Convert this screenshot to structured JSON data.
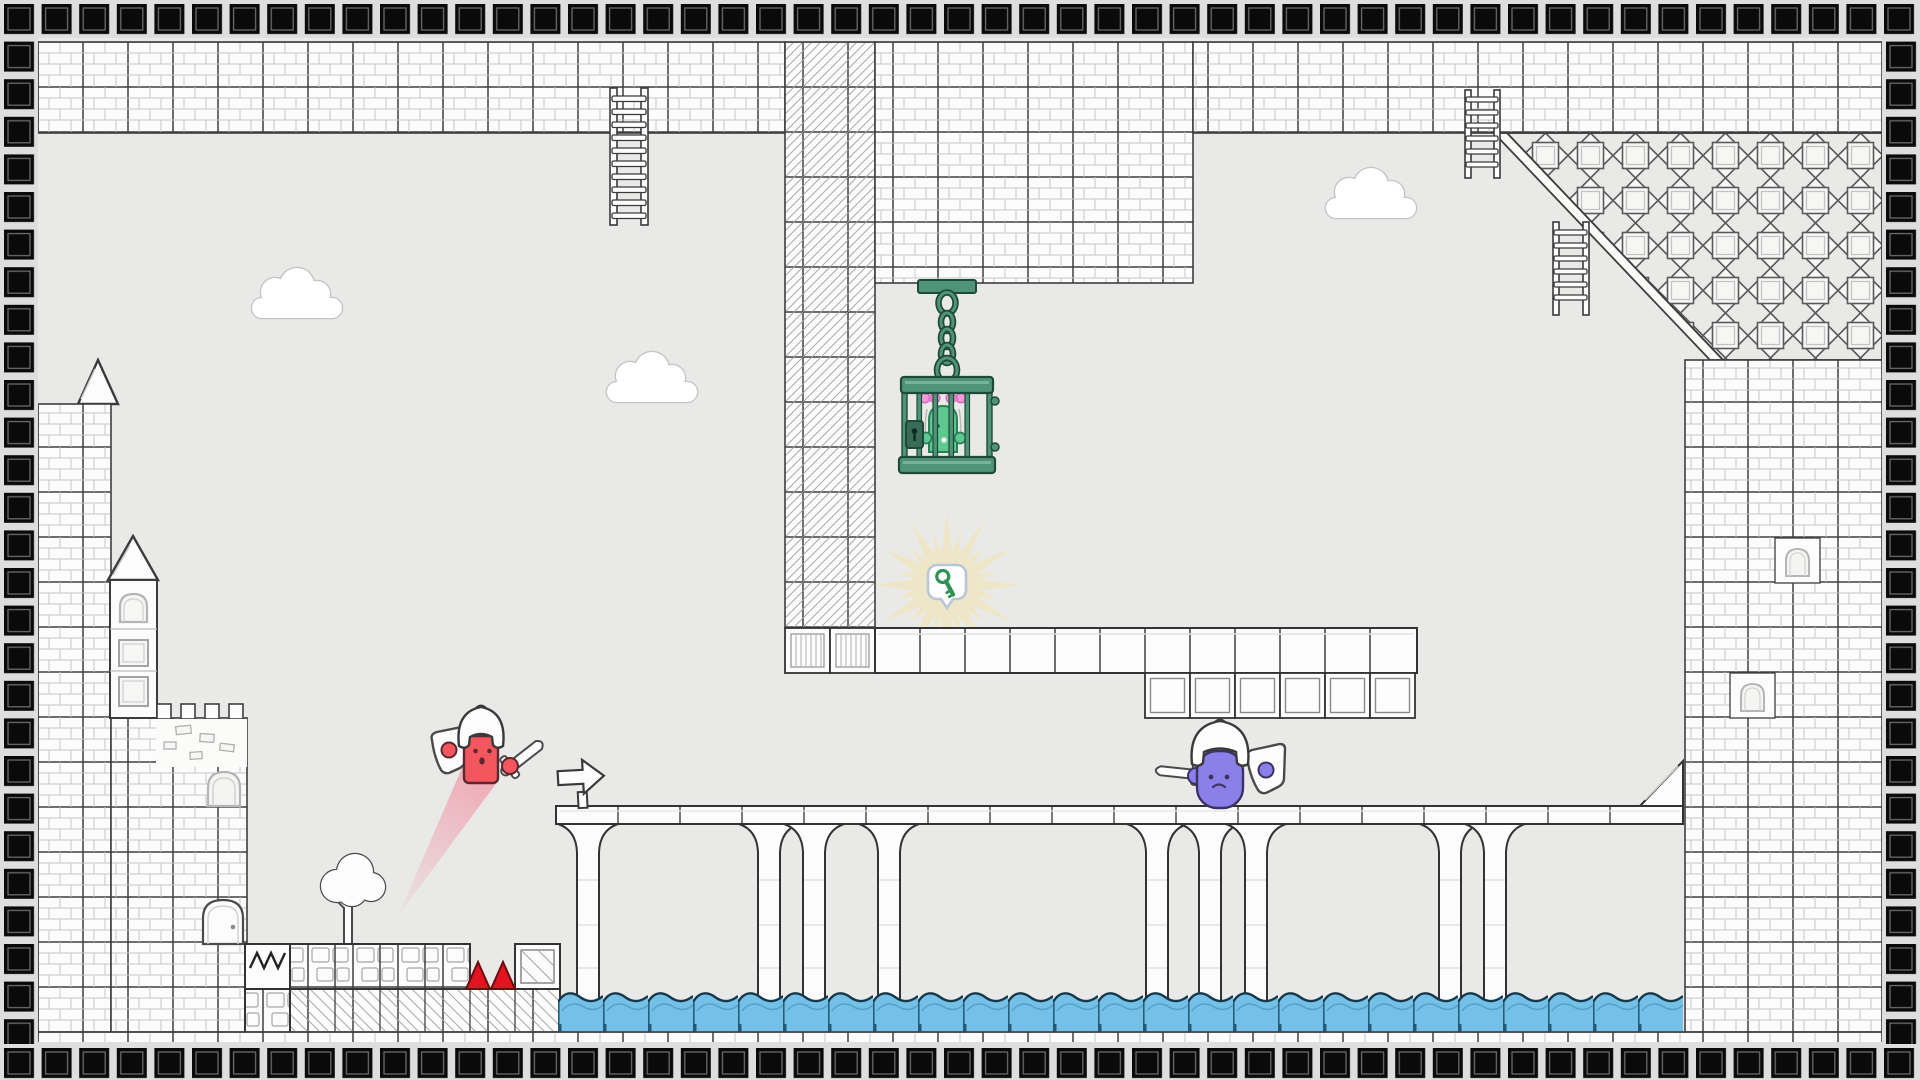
{
  "scene": {
    "name": "hand-drawn castle platformer level",
    "type": "game-screenshot"
  },
  "colors": {
    "page_bg": "#dedede",
    "area_bg": "#e9e9e7",
    "border_square": "#0a0a0a",
    "wall_fill": "#fcfcfc",
    "wall_line": "#3e3e3e",
    "brick_line": "#c6c6c6",
    "water_fill": "#74c0e6",
    "water_crest": "#17374b",
    "water_wave": "#4f9dc8",
    "spike_fill": "#e3131f",
    "spike_outline": "#6d0a10",
    "cage_fill": "#4f9479",
    "cage_outline": "#1f4a3a",
    "cage_light": "#79b39c",
    "slime_fill": "#5dc98f",
    "slime_outline": "#2c8057",
    "bow_fill": "#f49ada",
    "bow_outline": "#d46cbe",
    "red_body": "#f4565e",
    "red_outline": "#582830",
    "purple_body": "#8b80ea",
    "purple_outline": "#3a3263",
    "trail": "#f37d94",
    "glow": "#f3e6ae",
    "key_green": "#2e9254",
    "bubble_border": "#b9c6d8",
    "outline_dark": "#333333",
    "window_line": "#b5b5b5"
  },
  "entities": {
    "red_knight": {
      "label": "red knight dashing with sword and shield"
    },
    "purple_knight": {
      "label": "purple knight with sword and shield"
    },
    "caged_creature": {
      "label": "green creature with pink bows inside hanging cage"
    },
    "cage": {
      "label": "green hanging cage on chain with lock"
    },
    "key_pickup": {
      "label": "green key in glowing bubble"
    },
    "arrow_sign": {
      "label": "arrow sign",
      "direction": "right"
    },
    "spikes": {
      "label": "red floor spikes",
      "count": 2
    },
    "ladders": {
      "label": "ladders",
      "count": 3
    },
    "clouds": {
      "label": "clouds",
      "count": 3
    },
    "water": {
      "label": "water pool under bridge"
    },
    "tree": {
      "label": "white tree"
    },
    "door": {
      "label": "castle door"
    },
    "crate": {
      "label": "crate block"
    },
    "tower": {
      "label": "castle tower with spire"
    },
    "bridge": {
      "label": "arched stone bridge"
    },
    "star_block": {
      "label": "ornamental star tile block"
    }
  }
}
